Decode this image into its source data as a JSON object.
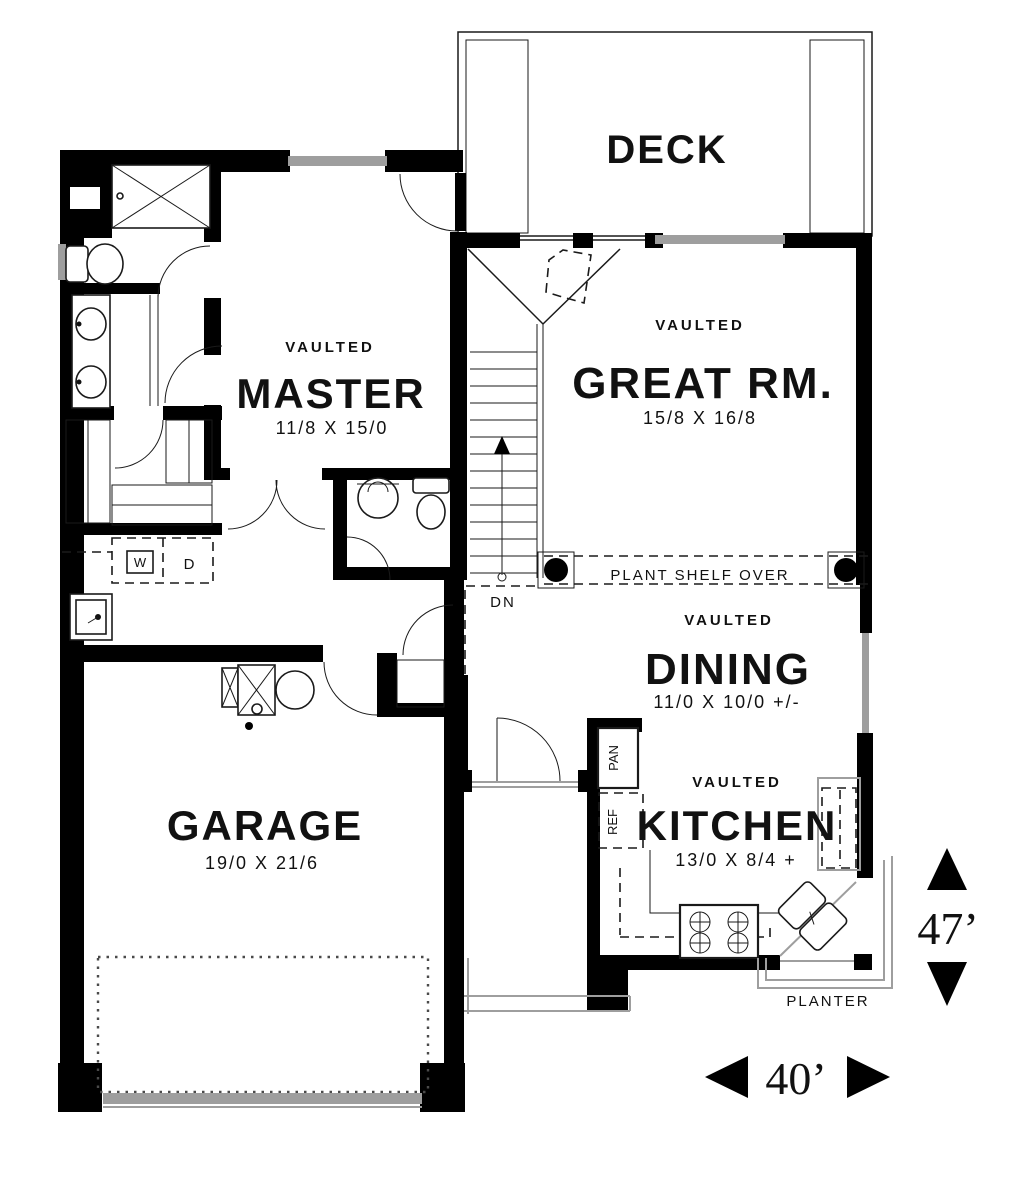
{
  "rooms": {
    "deck": {
      "name": "DECK"
    },
    "great": {
      "tag": "VAULTED",
      "name": "GREAT RM.",
      "dims": "15/8 X 16/8"
    },
    "master": {
      "tag": "VAULTED",
      "name": "MASTER",
      "dims": "11/8 X 15/0"
    },
    "dining": {
      "tag": "VAULTED",
      "name": "DINING",
      "dims": "11/0 X 10/0 +/-"
    },
    "kitchen": {
      "tag": "VAULTED",
      "name": "KITCHEN",
      "dims": "13/0 X 8/4 +"
    },
    "garage": {
      "name": "GARAGE",
      "dims": "19/0 X 21/6"
    }
  },
  "labels": {
    "plant_shelf": "PLANT SHELF OVER",
    "stairs_down": "DN",
    "pantry": "PAN",
    "fridge": "REF",
    "washer": "W",
    "dryer": "D",
    "planter": "PLANTER"
  },
  "dimensions": {
    "depth": "47’",
    "width": "40’"
  },
  "colors": {
    "wall": "#000000",
    "window": "#9e9e9e",
    "line": "#1a1a1a",
    "background": "#ffffff"
  }
}
